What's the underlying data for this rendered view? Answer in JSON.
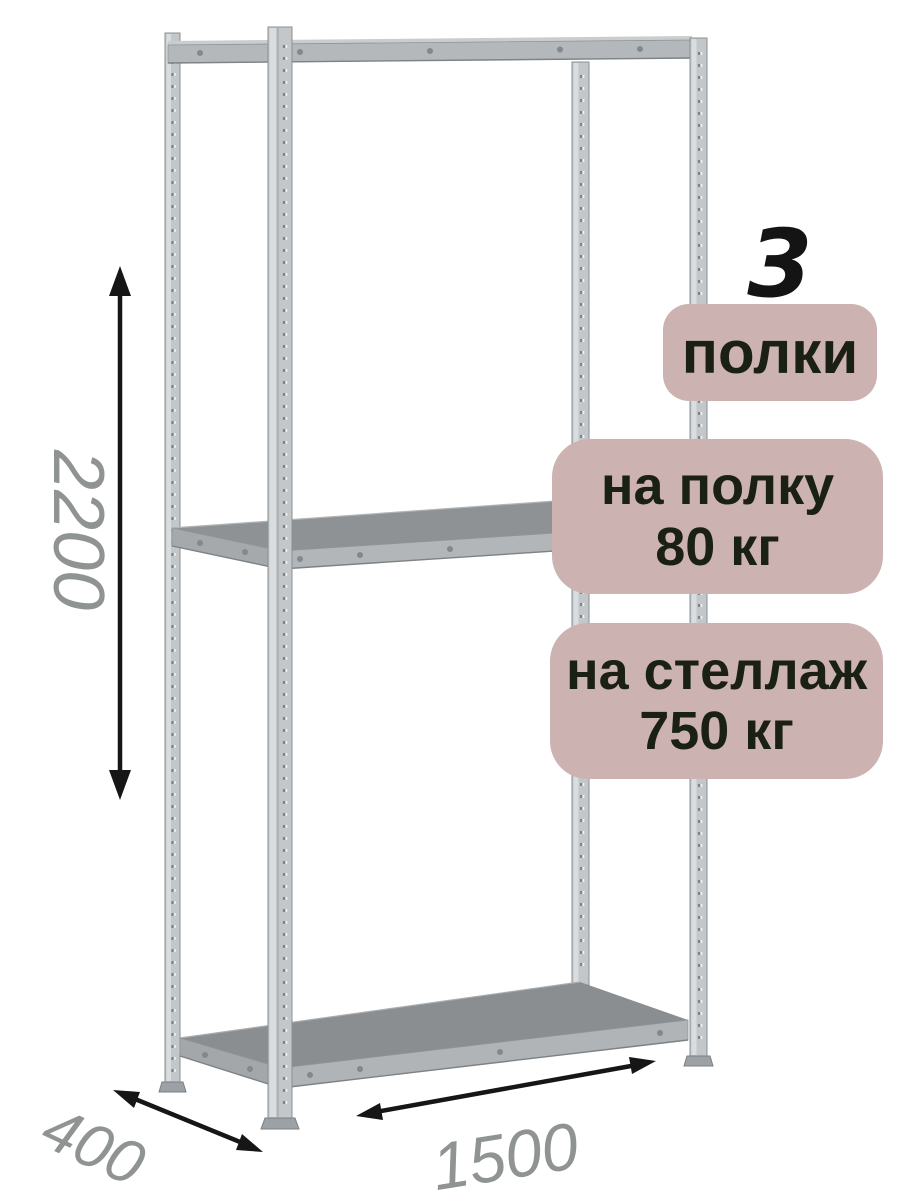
{
  "badges": {
    "count": {
      "value": "3",
      "label": "полки"
    },
    "shelf_load": {
      "line1": "на полку",
      "line2": "80 кг"
    },
    "rack_load": {
      "line1": "на стеллаж",
      "line2": "750 кг"
    }
  },
  "dimensions": {
    "height": "2200",
    "depth": "400",
    "width": "1500"
  },
  "colors": {
    "background": "#ffffff",
    "badge_background": "#ccb2b0",
    "badge_text": "#1a2014",
    "dimension_label": "#8f9392",
    "arrow": "#161616",
    "metal_light": "#dadde0",
    "metal_mid": "#c3c7ca",
    "shelf_top": "#8e9193"
  }
}
